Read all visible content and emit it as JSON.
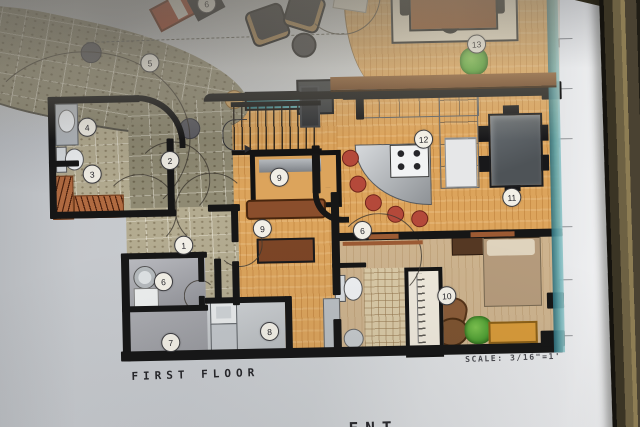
{
  "plan": {
    "title": "FIRST FLOOR",
    "scale_label": "SCALE: 3/16\"=1'",
    "partial_caption": "ENT"
  },
  "markers": [
    {
      "label": "1",
      "x": 183,
      "y": 243
    },
    {
      "label": "2",
      "x": 171,
      "y": 158
    },
    {
      "label": "3",
      "x": 93,
      "y": 170
    },
    {
      "label": "4",
      "x": 89,
      "y": 123
    },
    {
      "label": "5",
      "x": 153,
      "y": 60
    },
    {
      "label": "6",
      "x": 162,
      "y": 279
    },
    {
      "label": "6",
      "x": 362,
      "y": 232
    },
    {
      "label": "6",
      "x": 211,
      "y": 2
    },
    {
      "label": "7",
      "x": 168,
      "y": 340
    },
    {
      "label": "8",
      "x": 267,
      "y": 331
    },
    {
      "label": "9",
      "x": 280,
      "y": 177
    },
    {
      "label": "9",
      "x": 262,
      "y": 228
    },
    {
      "label": "10",
      "x": 445,
      "y": 299
    },
    {
      "label": "11",
      "x": 512,
      "y": 202
    },
    {
      "label": "12",
      "x": 425,
      "y": 142
    },
    {
      "label": "13",
      "x": 480,
      "y": 48
    }
  ],
  "ticks": [
    {
      "x": 562,
      "y": 44
    },
    {
      "x": 561,
      "y": 94
    },
    {
      "x": 560,
      "y": 144
    },
    {
      "x": 558,
      "y": 232
    },
    {
      "x": 557,
      "y": 285
    },
    {
      "x": 556,
      "y": 341
    }
  ],
  "colors": {
    "wood": "#dca45c",
    "wood_light": "#cdb38e",
    "stone": "#8f8a73",
    "wall": "#161616",
    "teal_edge": "#4a8f96",
    "frame": "#3f3b2c",
    "stool_red": "#b4493a",
    "plant_green": "#4f9e33",
    "table_brown": "#8a4a28",
    "dining_slate": "#5f666b",
    "bed_tan": "#b59b7c",
    "bench_gold": "#d79a39",
    "lounge_red": "#a83c22",
    "paper": "#cfd2d5"
  }
}
